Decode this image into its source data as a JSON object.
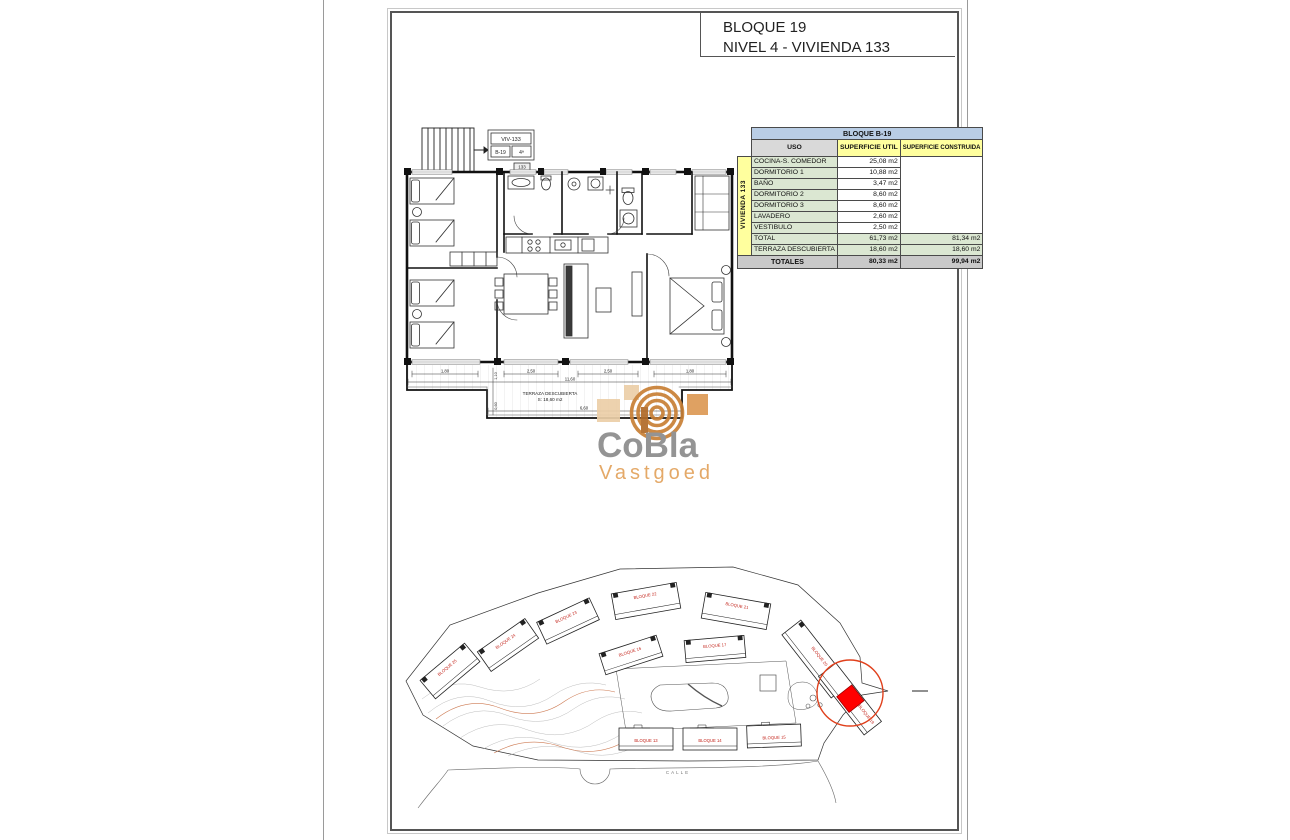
{
  "title_block": {
    "line1": "BLOQUE 19",
    "line2": "NIVEL 4 - VIVIENDA 133"
  },
  "table": {
    "block_header": "BLOQUE B-19",
    "col_uso": "USO",
    "col_util": "SUPERFICIE UTIL",
    "col_construida": "SUPERFICIE CONSTRUIDA",
    "side_label": "VIVIENDA 133",
    "rows": [
      {
        "uso": "COCINA-S. COMEDOR",
        "util": "25,08 m2"
      },
      {
        "uso": "DORMITORIO 1",
        "util": "10,88 m2"
      },
      {
        "uso": "BAÑO",
        "util": "3,47 m2"
      },
      {
        "uso": "DORMITORIO 2",
        "util": "8,60 m2"
      },
      {
        "uso": "DORMITORIO 3",
        "util": "8,60 m2"
      },
      {
        "uso": "LAVADERO",
        "util": "2,60 m2"
      },
      {
        "uso": "VESTIBULO",
        "util": "2,50 m2"
      }
    ],
    "total": {
      "label": "TOTAL",
      "util": "61,73 m2",
      "construida": "81,34 m2"
    },
    "terraza": {
      "label": "TERRAZA DESCUBIERTA",
      "util": "18,60 m2",
      "construida": "18,60 m2"
    },
    "totales": {
      "label": "TOTALES",
      "util": "80,33 m2",
      "construida": "99,94 m2"
    },
    "colors": {
      "header_blue": "#b9cde5",
      "header_yellow": "#ffff9e",
      "row_green": "#dbe7d2",
      "totales_gray": "#c9c9c9",
      "side_yellow": "#ffff9e"
    }
  },
  "floorplan": {
    "unit_tag": {
      "name": "VIV-133",
      "cell1": "B-19",
      "cell2": "4ª",
      "small": "133"
    },
    "terrace_label1": "TERRAZA DESCUBIERTA",
    "terrace_label2": "S: 18,60 m2",
    "dims": {
      "d1": "1,80",
      "d2": "2,50",
      "d3": "2,50",
      "d4": "1,80",
      "total_w": "11,60",
      "bottom_w": "6,60",
      "v1": "1,10",
      "v2": "0,60"
    }
  },
  "logo": {
    "name": "CoBla",
    "sub": "Vastgoed",
    "color_gray": "#8c8c8c",
    "color_orange": "#e2a25c",
    "color_ring": "#c87f35"
  },
  "siteplan": {
    "road_label": "CALLE",
    "highlight_color": "#ff0000",
    "circle_color": "#e0401c",
    "label_color": "#c3231a",
    "buildings": [
      {
        "label": "BLOQUE 25"
      },
      {
        "label": "BLOQUE 24"
      },
      {
        "label": "BLOQUE 23"
      },
      {
        "label": "BLOQUE 22"
      },
      {
        "label": "BLOQUE 21"
      },
      {
        "label": "BLOQUE 20"
      },
      {
        "label": "BLOQUE 19"
      },
      {
        "label": "BLOQUE 16"
      },
      {
        "label": "BLOQUE 17"
      },
      {
        "label": "BLOQUE 13"
      },
      {
        "label": "BLOQUE 14"
      },
      {
        "label": "BLOQUE 15"
      }
    ]
  }
}
